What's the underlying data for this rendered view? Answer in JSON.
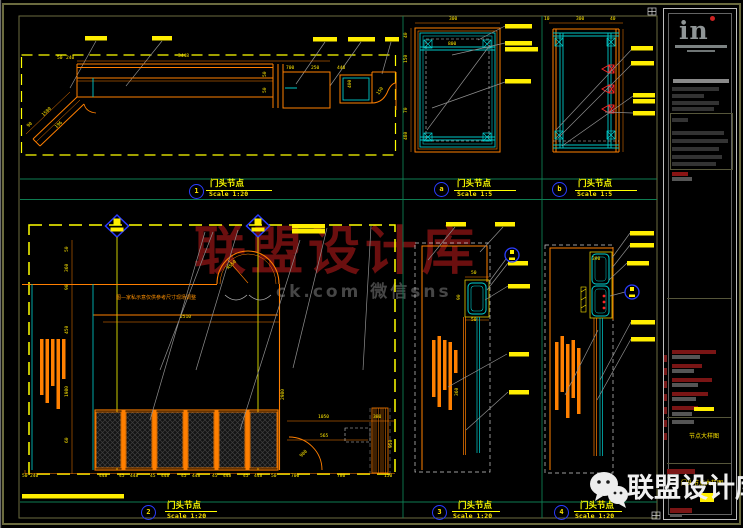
{
  "watermark": {
    "center": "联盟设计库",
    "sub": "ck.com 微信sns",
    "bottom": "联盟设计库"
  },
  "views": {
    "v1": {
      "num": "1",
      "title": "门头节点",
      "scale": "Scale 1:20",
      "dims": {
        "top": "3448",
        "a": "50",
        "b": "240",
        "c": "700",
        "d": "250",
        "e": "440",
        "f": "400",
        "g": "150",
        "h": "1580",
        "i": "196",
        "j": "90",
        "k": "50",
        "l": "50"
      }
    },
    "va": {
      "num": "a",
      "title": "门头节点",
      "scale": "Scale 1:5",
      "dims": {
        "top": "300",
        "inner": "800",
        "l1": "40",
        "l2": "150",
        "l3": "70",
        "l4": "480"
      }
    },
    "vb": {
      "num": "b",
      "title": "门头节点",
      "scale": "Scale 1:5",
      "dims": {
        "t1": "10",
        "t2": "300",
        "t3": "40"
      }
    },
    "v2": {
      "num": "2",
      "title": "门头节点",
      "scale": "Scale 1:20",
      "note": "图—家私示意仅供参考尺寸现场调整",
      "dims": {
        "w": "2510",
        "r": "R550",
        "arc": "900",
        "d1": "1050",
        "d2": "380",
        "d3": "565",
        "v": "2980",
        "right": "950",
        "s1": "50",
        "s2": "360",
        "s3": "90",
        "s4": "450",
        "s5": "1980",
        "s6": "60",
        "chain": [
          "50",
          "240",
          "448",
          "45",
          "448",
          "45",
          "448",
          "45",
          "448",
          "45",
          "448",
          "45",
          "448",
          "50",
          "700",
          "780",
          "150"
        ]
      }
    },
    "v3": {
      "num": "3",
      "title": "门头节点",
      "scale": "Scale 1:20",
      "dims": {
        "t": "50",
        "b": "50",
        "s": "90",
        "v": "360"
      }
    },
    "v4": {
      "num": "4",
      "title": "门头节点",
      "scale": "Scale 1:20",
      "dims": {
        "t": "390"
      }
    }
  },
  "titleblock": {
    "logo": "in",
    "mid_label": "节点大样图",
    "drawing_label": "门头节点大样图"
  }
}
